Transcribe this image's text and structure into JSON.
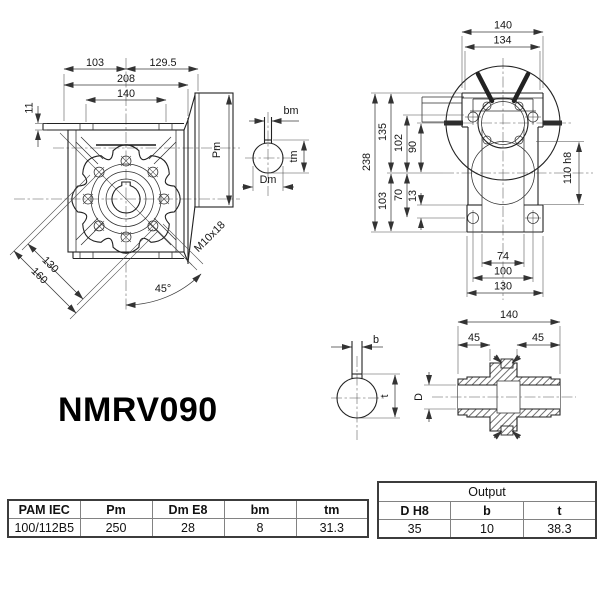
{
  "title": "NMRV090",
  "front": {
    "d103": "103",
    "d129_5": "129.5",
    "d208": "208",
    "d140": "140",
    "d11": "11",
    "pm": "Pm",
    "d130": "130",
    "d160": "160",
    "a45": "45°",
    "m10": "M10x18"
  },
  "side": {
    "d140": "140",
    "d134": "134",
    "d238": "238",
    "d135": "135",
    "d102": "102",
    "d90": "90",
    "d103": "103",
    "d70": "70",
    "d13": "13",
    "d110": "110 h8",
    "d74": "74",
    "d100": "100",
    "d130": "130"
  },
  "motor_bore": {
    "bm": "bm",
    "tm": "tm",
    "dm": "Dm"
  },
  "output_bore": {
    "b": "b",
    "t": "t"
  },
  "shaft": {
    "d140": "140",
    "d45a": "45",
    "d45b": "45",
    "dD": "D"
  },
  "pam_table": {
    "headers": [
      "PAM IEC",
      "Pm",
      "Dm E8",
      "bm",
      "tm"
    ],
    "row": [
      "100/112B5",
      "250",
      "28",
      "8",
      "31.3"
    ]
  },
  "output_table": {
    "title": "Output",
    "headers": [
      "D H8",
      "b",
      "t"
    ],
    "row": [
      "35",
      "10",
      "38.3"
    ]
  }
}
